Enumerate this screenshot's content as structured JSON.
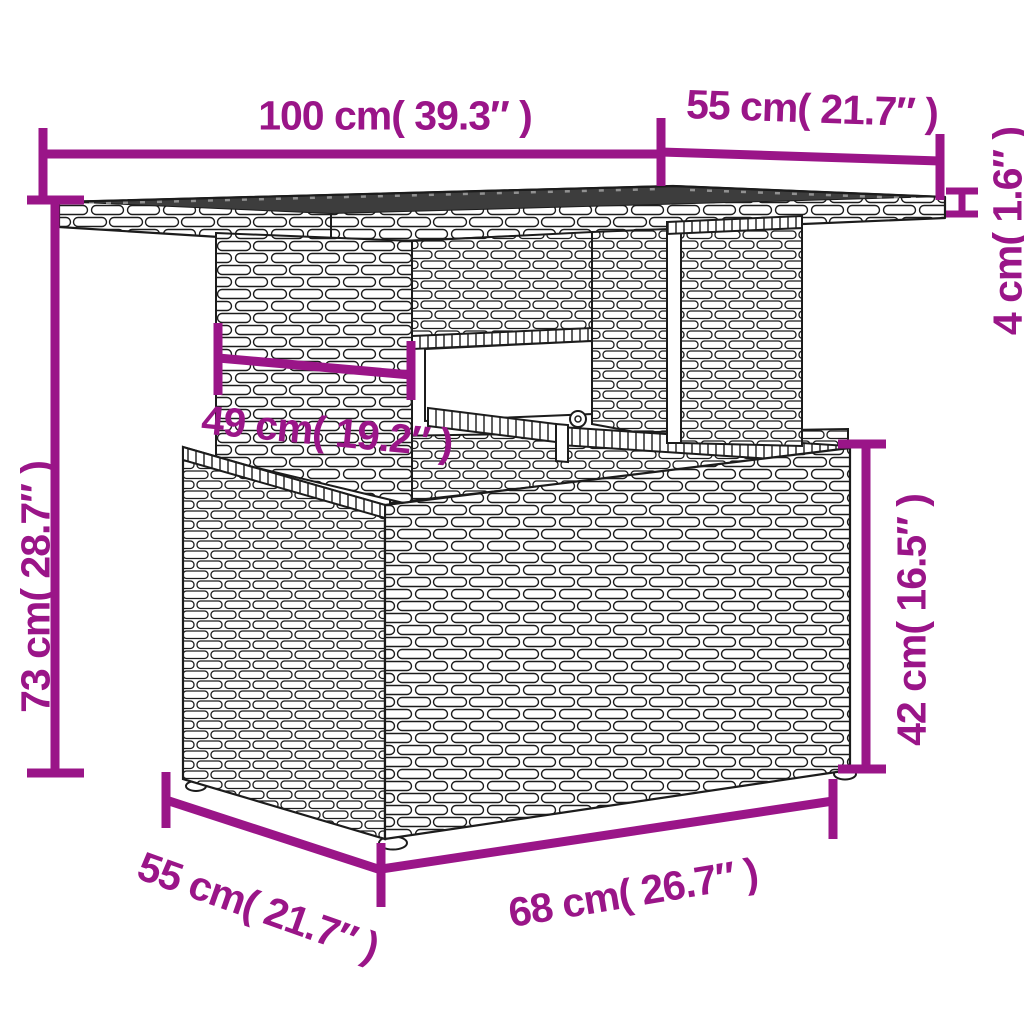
{
  "title": "Rattan garden table dimension diagram",
  "colors": {
    "accent": "#9a1588",
    "tabletop": "#3d3d3d",
    "line": "#1c1c1c"
  },
  "dimensions": {
    "top_width": {
      "label": "100 cm( 39.3″ )"
    },
    "top_depth": {
      "label": "55 cm( 21.7″ )"
    },
    "top_thickness": {
      "label": "4 cm( 1.6″ )"
    },
    "total_height": {
      "label": "73 cm( 28.7″ )"
    },
    "column_width": {
      "label": "49 cm( 19.2″ )"
    },
    "base_height": {
      "label": "42 cm( 16.5″ )"
    },
    "base_width": {
      "label": "68 cm( 26.7″ )"
    },
    "base_depth": {
      "label": "55 cm( 21.7″ )"
    }
  }
}
